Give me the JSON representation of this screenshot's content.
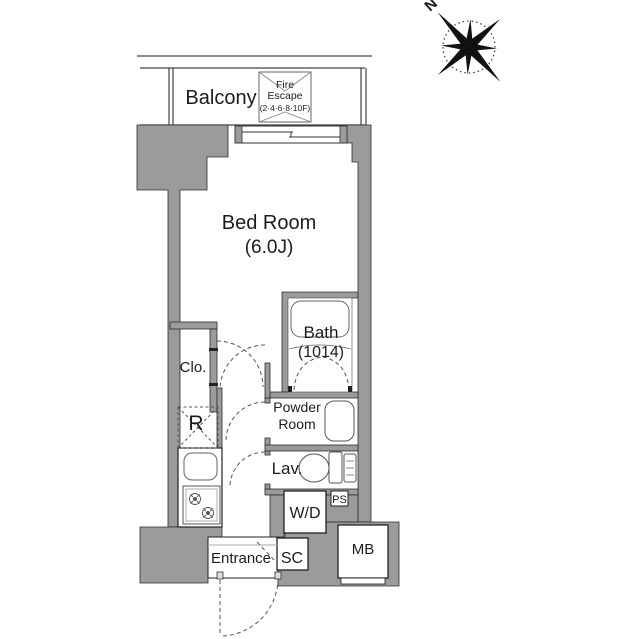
{
  "title": "Apartment floor plan",
  "compass": {
    "north": "N"
  },
  "balcony": {
    "label": "Balcony"
  },
  "fire_escape": {
    "line1": "Fire",
    "line2": "Escape",
    "line3": "(2·4·6·8·10F)"
  },
  "rooms": {
    "bedroom": {
      "name": "Bed Room",
      "size": "(6.0J)"
    },
    "bath": {
      "name": "Bath",
      "size": "(1014)"
    },
    "closet": {
      "label": "Clo."
    },
    "refrigerator_space": {
      "label": "R"
    },
    "powder_room": {
      "line1": "Powder",
      "line2": "Room"
    },
    "lavatory": {
      "label": "Lav."
    },
    "pipe_space": {
      "label": "PS"
    },
    "washer_dryer": {
      "label": "W/D"
    },
    "entrance": {
      "label": "Entrance"
    },
    "shoe_closet": {
      "label": "SC"
    },
    "meter_box": {
      "label": "MB"
    }
  },
  "colors": {
    "wall_fill": "#9b9b9b",
    "line": "#333333",
    "dash": "#555555",
    "background": "#ffffff"
  }
}
